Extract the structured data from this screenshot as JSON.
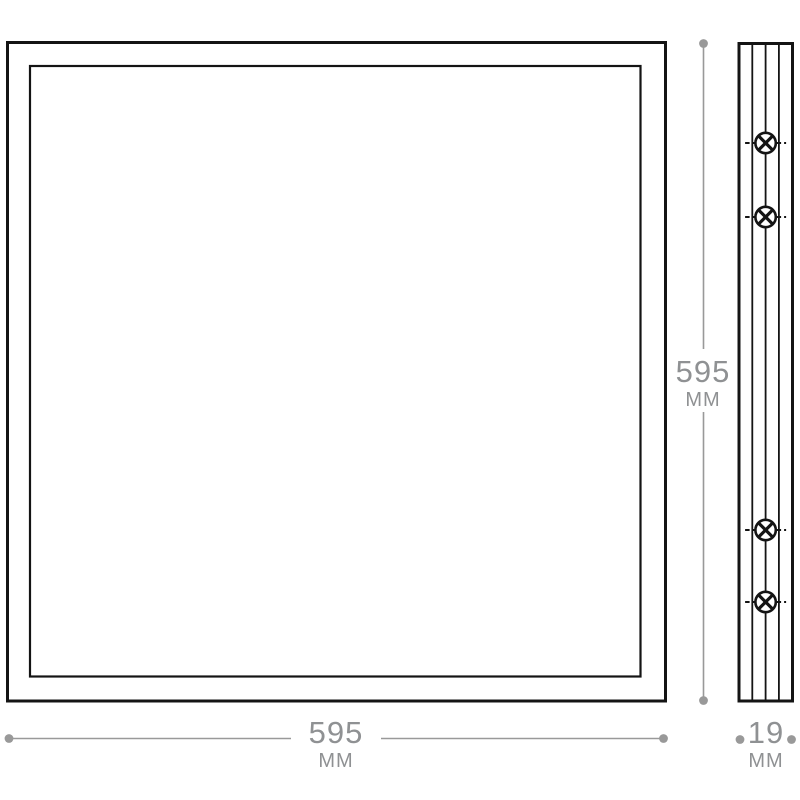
{
  "drawing": {
    "views": {
      "front": "panel-front-view",
      "side": "panel-side-profile-view"
    },
    "side_view_screw_count": 4
  },
  "dimensions": {
    "width": {
      "value": "595",
      "unit": "MM"
    },
    "height": {
      "value": "595",
      "unit": "MM"
    },
    "depth": {
      "value": "19",
      "unit": "MM"
    }
  },
  "icons": {
    "screw_symbol": "circled-cross"
  },
  "colors": {
    "outline_black": "#141414",
    "dimension_gray": "#999999",
    "label_gray": "#8f9193",
    "background": "#ffffff"
  }
}
